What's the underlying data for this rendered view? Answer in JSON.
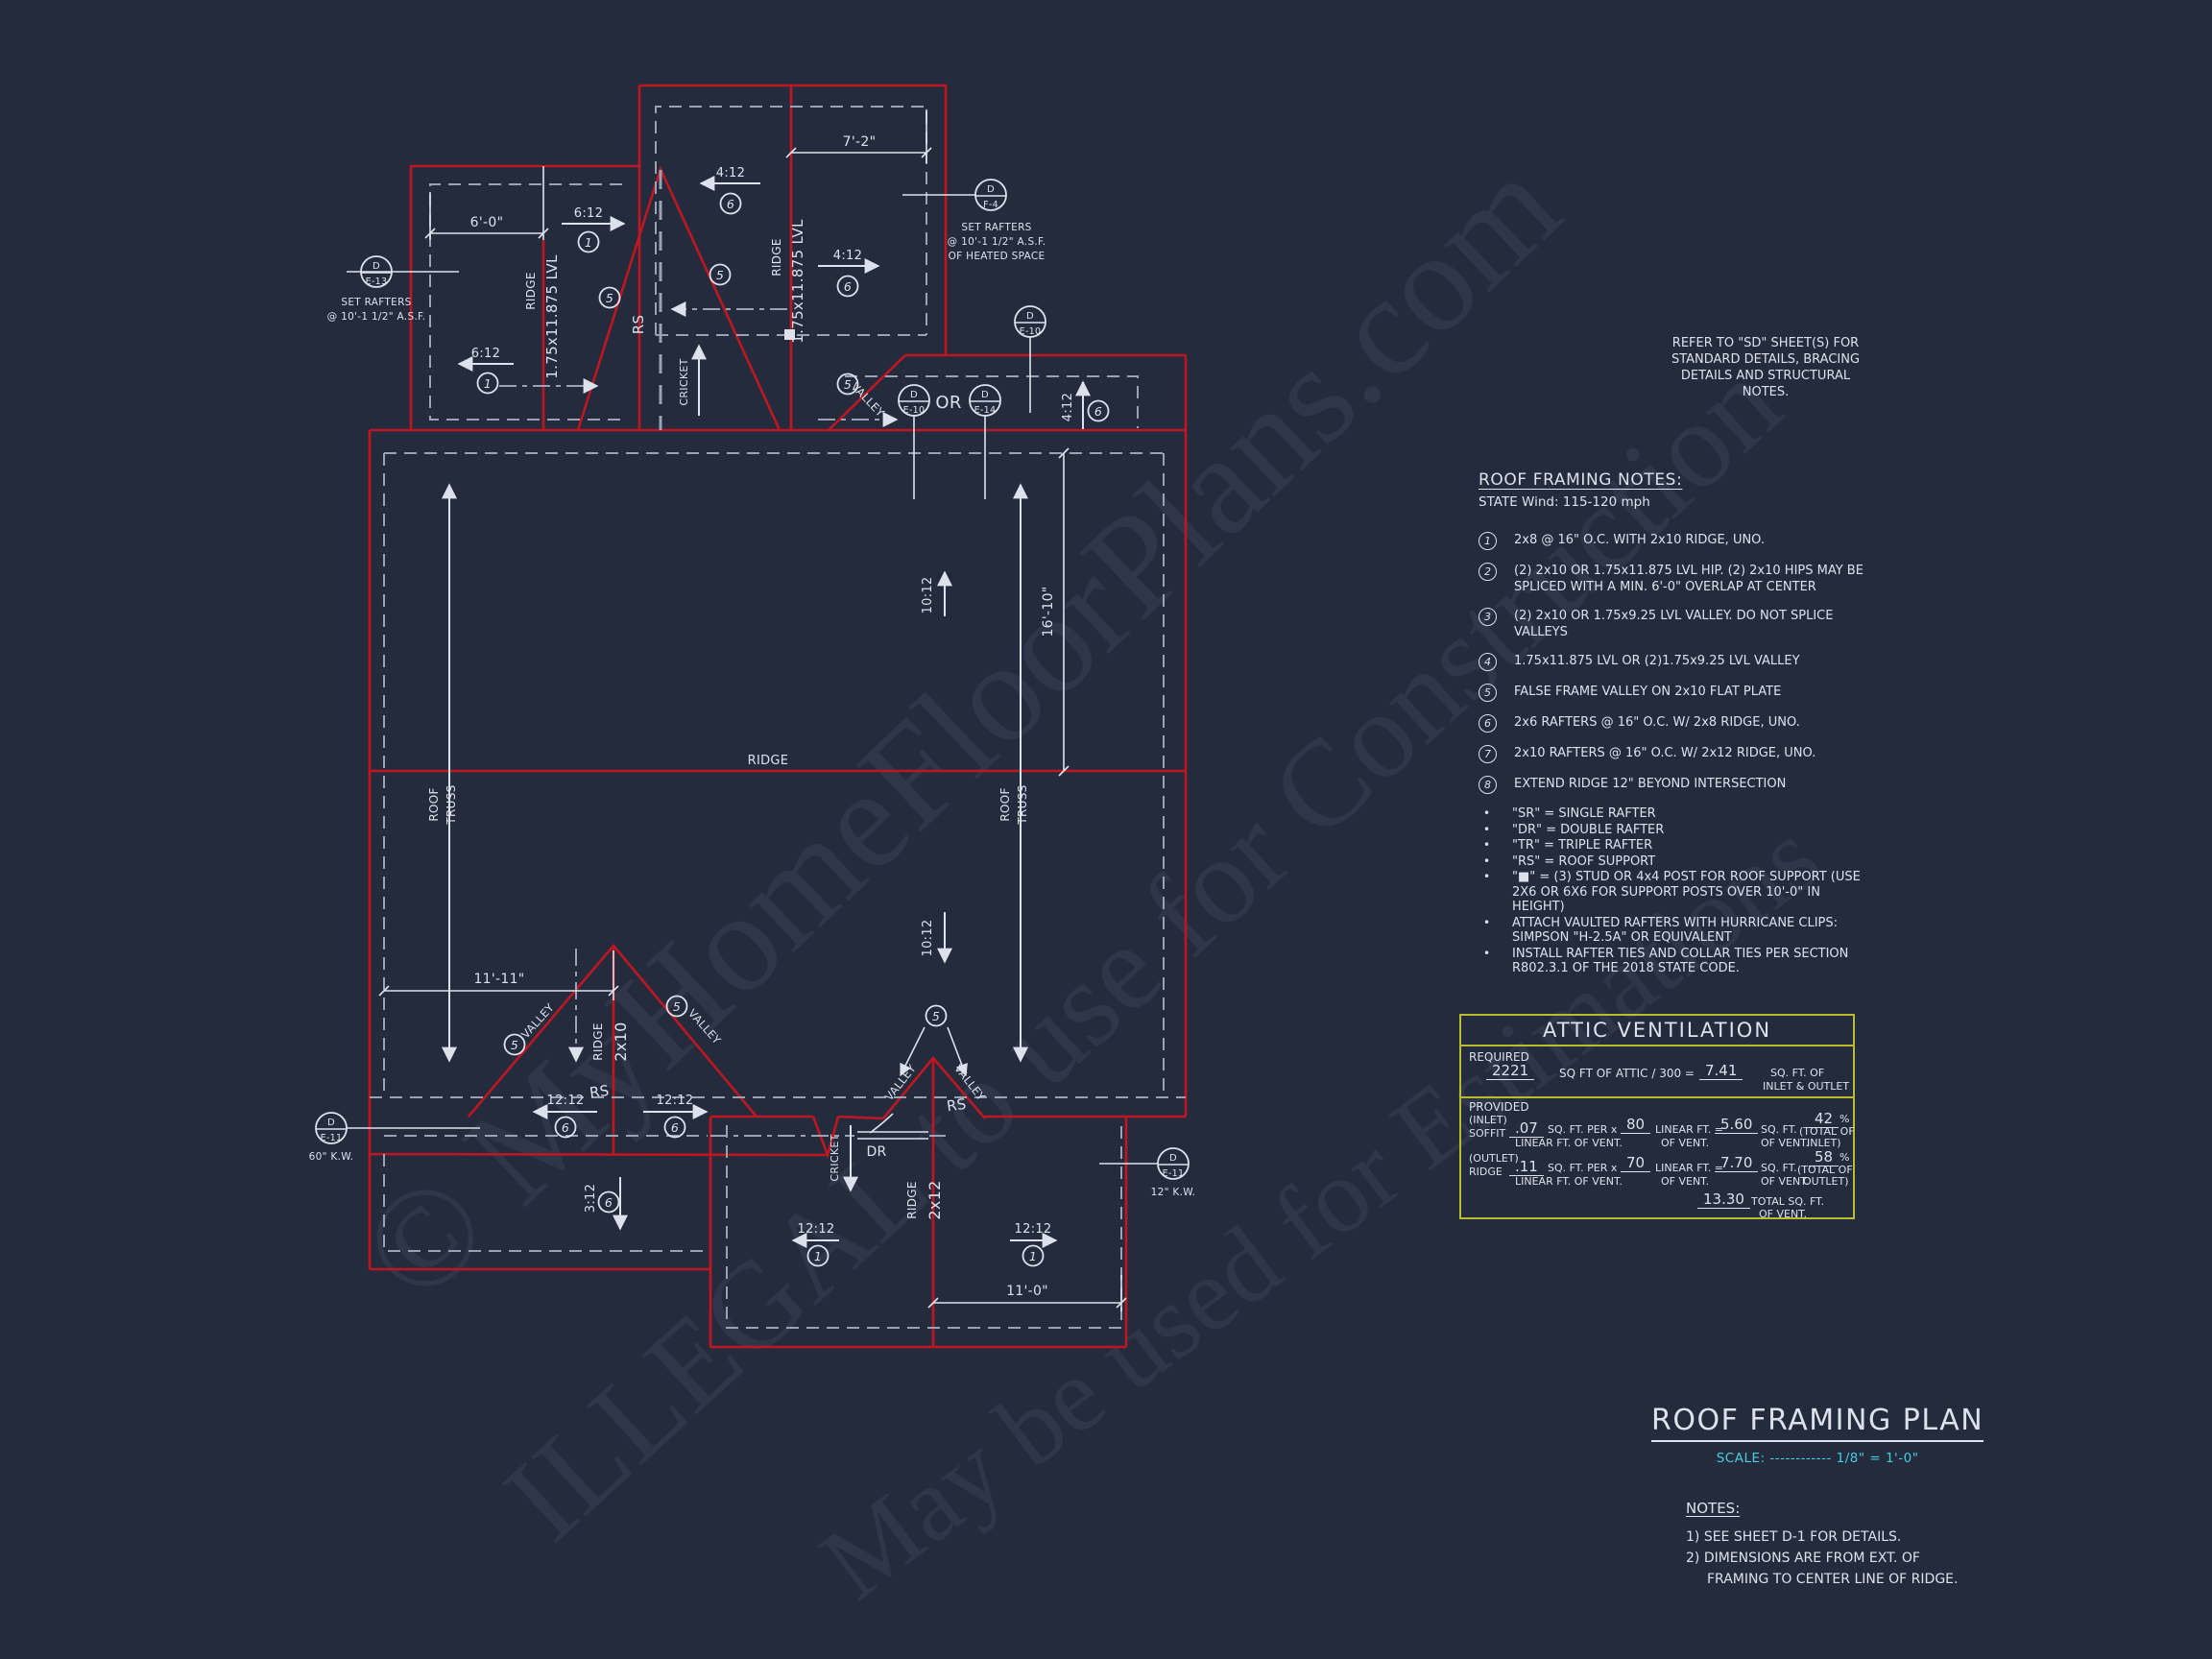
{
  "colors": {
    "background": "#242b3d",
    "red": "#bf1722",
    "line": "#dde1ec",
    "dash": "#9aa2b5",
    "cyan": "#45cede",
    "table_border": "#b9bc2e"
  },
  "watermarks": {
    "line1": "© MyHomeFloorPlans.com",
    "line2": "ILLEGAL to use for Construction",
    "line3": "May be used for Estimations"
  },
  "refer_note": {
    "l1": "REFER TO \"SD\"  SHEET(S) FOR",
    "l2": "STANDARD DETAILS, BRACING",
    "l3": "DETAILS AND STRUCTURAL NOTES."
  },
  "framing_notes": {
    "title": "ROOF FRAMING NOTES:",
    "subtitle": "STATE Wind:  115-120 mph",
    "bullet_glyph": "•",
    "numbered": [
      {
        "num": "1",
        "lines": [
          "2x8 @ 16\" O.C. WITH 2x10 RIDGE, UNO."
        ]
      },
      {
        "num": "2",
        "lines": [
          "(2) 2x10 OR 1.75x11.875 LVL HIP. (2) 2x10 HIPS MAY BE",
          "SPLICED WITH A MIN. 6'-0\" OVERLAP AT CENTER"
        ]
      },
      {
        "num": "3",
        "lines": [
          "(2) 2x10 OR 1.75x9.25 LVL VALLEY. DO NOT SPLICE",
          "VALLEYS"
        ]
      },
      {
        "num": "4",
        "lines": [
          "1.75x11.875 LVL OR (2)1.75x9.25 LVL VALLEY"
        ]
      },
      {
        "num": "5",
        "lines": [
          "FALSE FRAME VALLEY ON 2x10 FLAT PLATE"
        ]
      },
      {
        "num": "6",
        "lines": [
          "2x6 RAFTERS @ 16\" O.C. W/ 2x8 RIDGE, UNO."
        ]
      },
      {
        "num": "7",
        "lines": [
          "2x10 RAFTERS @ 16\" O.C. W/ 2x12 RIDGE, UNO."
        ]
      },
      {
        "num": "8",
        "lines": [
          "EXTEND RIDGE 12\" BEYOND INTERSECTION"
        ]
      }
    ],
    "bullets": [
      {
        "lines": [
          "\"SR\"  = SINGLE RAFTER"
        ]
      },
      {
        "lines": [
          "\"DR\" = DOUBLE RAFTER"
        ]
      },
      {
        "lines": [
          "\"TR\" = TRIPLE RAFTER"
        ]
      },
      {
        "lines": [
          "\"RS\" = ROOF SUPPORT"
        ]
      },
      {
        "lines": [
          "\"■\" = (3) STUD OR 4x4 POST FOR ROOF SUPPORT (USE",
          "2X6 OR 6X6 FOR SUPPORT POSTS OVER 10'-0\" IN",
          "HEIGHT)"
        ]
      },
      {
        "lines": [
          "ATTACH VAULTED RAFTERS WITH HURRICANE CLIPS:",
          "SIMPSON \"H-2.5A\" OR EQUIVALENT"
        ]
      },
      {
        "lines": [
          "INSTALL RAFTER TIES AND COLLAR TIES PER SECTION",
          "R802.3.1 OF THE 2018 STATE CODE."
        ]
      }
    ]
  },
  "attic": {
    "title": "ATTIC VENTILATION",
    "required": "REQUIRED",
    "provided": "PROVIDED",
    "attic_sqft": "2221",
    "divisor_text": "SQ FT OF ATTIC / 300 =",
    "required_sqft": "7.41",
    "of1": "SQ. FT. OF",
    "of2": "INLET & OUTLET",
    "inlet": "(INLET)",
    "soffit": "SOFFIT",
    "inlet_rate": ".07",
    "per": "SQ. FT. PER x",
    "per_sub": "LINEAR FT. OF VENT.",
    "inlet_lf": "80",
    "lf_eq": "LINEAR FT. =",
    "of_vent": "OF VENT.",
    "inlet_sqft": "5.60",
    "sqft": "SQ. FT.",
    "inlet_pct": "42",
    "pct": "%",
    "total_of": "(TOTAL OF",
    "inlet_close": "INLET)",
    "outlet": "(OUTLET)",
    "ridge": "RIDGE",
    "outlet_rate": ".11",
    "outlet_lf": "70",
    "outlet_sqft": "7.70",
    "outlet_pct": "58",
    "outlet_close": "OUTLET)",
    "total_sqft": "13.30",
    "total_label": "TOTAL  SQ. FT.",
    "total_sub": "OF VENT."
  },
  "title_block": {
    "title": "ROOF FRAMING PLAN",
    "scale_label": "SCALE:",
    "scale_dots": "------------",
    "scale_value": "1/8\" = 1'-0\"",
    "notes_title": "NOTES:",
    "note1": "1)  SEE SHEET D-1 FOR DETAILS.",
    "note2": "2)  DIMENSIONS ARE FROM EXT. OF",
    "note3": "FRAMING TO CENTER LINE OF RIDGE."
  },
  "plan": {
    "labels": {
      "d": "D",
      "e13": "E-13",
      "f4": "F-4",
      "e10": "E-10",
      "e14": "E-14",
      "e11": "E-11",
      "or": "OR",
      "set_rafters": "SET RAFTERS",
      "asf": "@ 10'-1 1/2\" A.S.F.",
      "heated": "OF HEATED SPACE",
      "kw60": "60\" K.W.",
      "kw12": "12\" K.W.",
      "ridge": "RIDGE",
      "lvl": "1.75x11.875 LVL",
      "x210": "2x10",
      "x212": "2x12",
      "roof": "ROOF",
      "truss": "TRUSS",
      "rs": "RS",
      "dr": "DR",
      "cricket": "CRICKET",
      "valley": "VALLEY",
      "p612": "6:12",
      "p412": "4:12",
      "p1012": "10:12",
      "p1212": "12:12",
      "p312": "3:12",
      "n1": "1",
      "n5": "5",
      "n6": "6",
      "d60": "6'-0\"",
      "d72": "7'-2\"",
      "d1111": "11'-11\"",
      "d110": "11'-0\"",
      "d1610": "16'-10\""
    }
  }
}
